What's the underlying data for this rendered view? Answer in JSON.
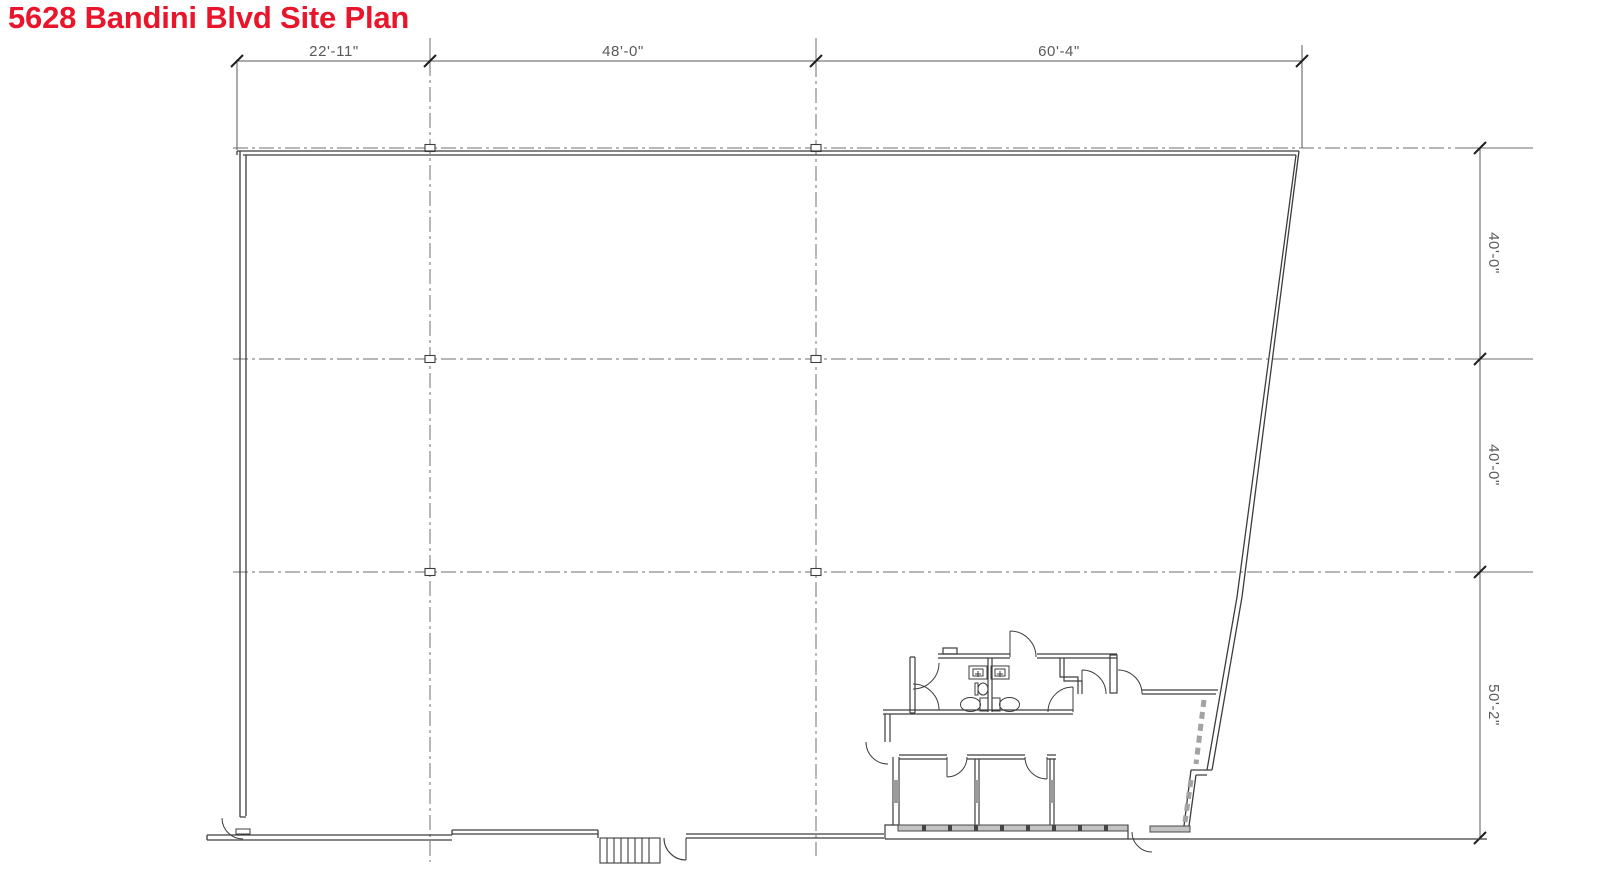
{
  "title": "5628 Bandini Blvd Site Plan",
  "colors": {
    "title_red": "#e8152b",
    "wall_line": "#3d3d3d",
    "dim_line": "#5a5a5a",
    "grid_line": "#6f6f6f",
    "glazing_gray": "#c3c3c3"
  },
  "dimensions": {
    "top": [
      {
        "label": "22'-11\""
      },
      {
        "label": "48'-0\""
      },
      {
        "label": "60'-4\""
      }
    ],
    "right": [
      {
        "label": "40'-0\""
      },
      {
        "label": "40'-0\""
      },
      {
        "label": "50'-2\""
      }
    ]
  }
}
